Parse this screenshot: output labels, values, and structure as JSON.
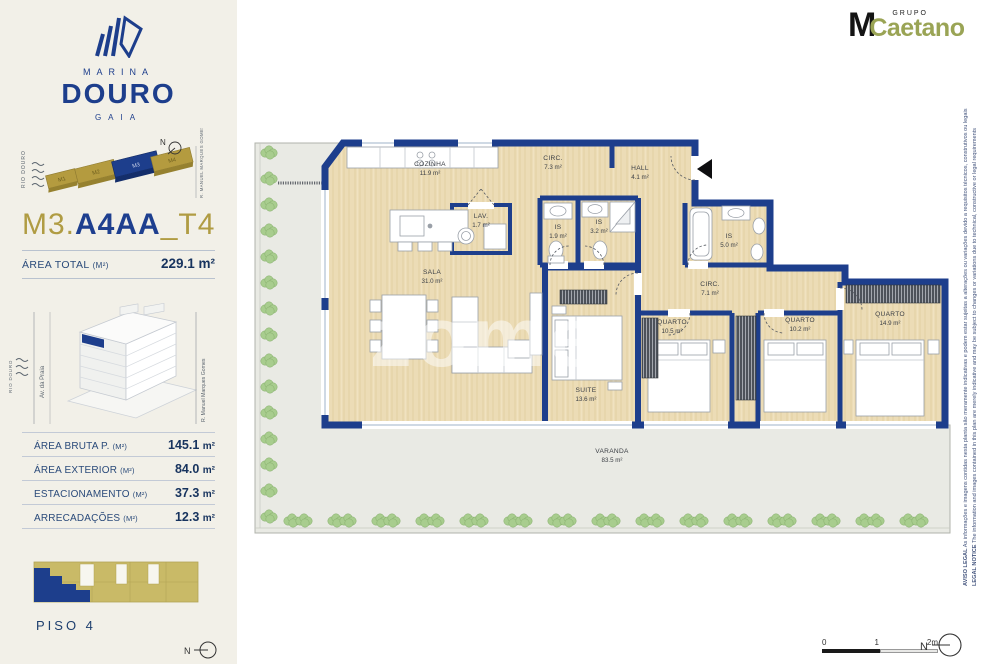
{
  "header": {
    "grupo": "GRUPO",
    "m": "M",
    "caetano": "Caetano"
  },
  "sidebar": {
    "brand": {
      "marina": "MARINA",
      "douro": "DOURO",
      "gaia": "GAIA"
    },
    "site_map": {
      "river": "RIO DOURO",
      "street": "R. MANUEL MARQUES GOMES",
      "north": "N",
      "blocks": [
        {
          "label": "M1",
          "highlight": false
        },
        {
          "label": "M2",
          "highlight": false
        },
        {
          "label": "M3",
          "highlight": true
        },
        {
          "label": "M4",
          "highlight": false
        }
      ]
    },
    "unit": {
      "prefix": "M3.",
      "code": "A4AA",
      "suffix": "_T4"
    },
    "area_total": {
      "label": "ÁREA TOTAL",
      "unit": "(M²)",
      "value": "229.1",
      "value_unit": "m²"
    },
    "building": {
      "river": "RIO DOURO",
      "street_left": "Av. da Praia",
      "street_right": "R. Manuel Marques Gomes"
    },
    "area_table": [
      {
        "label": "ÁREA BRUTA P.",
        "unit": "(M²)",
        "value": "145.1",
        "value_unit": "m²"
      },
      {
        "label": "ÁREA EXTERIOR",
        "unit": "(M²)",
        "value": "84.0",
        "value_unit": "m²"
      },
      {
        "label": "ESTACIONAMENTO",
        "unit": "(M²)",
        "value": "37.3",
        "value_unit": "m²"
      },
      {
        "label": "ARRECADAÇÕES",
        "unit": "(M²)",
        "value": "12.3",
        "value_unit": "m²"
      }
    ],
    "floor": {
      "label": "PISO 4",
      "north": "N"
    }
  },
  "plan": {
    "watermark": "zome",
    "rooms": [
      {
        "name": "COZINHA",
        "area": "11.9 m²",
        "x": 190,
        "y": 38
      },
      {
        "name": "CIRC.",
        "area": "7.3 m²",
        "x": 313,
        "y": 32
      },
      {
        "name": "HALL",
        "area": "4.1 m²",
        "x": 400,
        "y": 42
      },
      {
        "name": "LAV.",
        "area": "1.7 m²",
        "x": 241,
        "y": 90
      },
      {
        "name": "IS",
        "area": "1.9 m²",
        "x": 318,
        "y": 101
      },
      {
        "name": "IS",
        "area": "3.2 m²",
        "x": 359,
        "y": 96
      },
      {
        "name": "IS",
        "area": "5.0 m²",
        "x": 489,
        "y": 110
      },
      {
        "name": "SALA",
        "area": "31.0 m²",
        "x": 192,
        "y": 146
      },
      {
        "name": "SUITE",
        "area": "13.6 m²",
        "x": 346,
        "y": 264
      },
      {
        "name": "CIRC.",
        "area": "7.1 m²",
        "x": 470,
        "y": 158
      },
      {
        "name": "QUARTO",
        "area": "10.5 m²",
        "x": 432,
        "y": 196
      },
      {
        "name": "QUARTO",
        "area": "10.2 m²",
        "x": 560,
        "y": 194
      },
      {
        "name": "QUARTO",
        "area": "14.9 m²",
        "x": 650,
        "y": 188
      },
      {
        "name": "VARANDA",
        "area": "83.5 m²",
        "x": 372,
        "y": 325
      }
    ],
    "scale": {
      "t0": "0",
      "t1": "1",
      "t2": "2m"
    },
    "north": "N",
    "legal": {
      "pt_bold": "AVISO LEGAL",
      "pt": " As informações e imagens contidas nesta planta são meramente indicativas e podem estar sujeitas a alterações ou variações devido a requisitos técnicos, construtivos ou legais",
      "en_bold": "LEGAL NOTICE",
      "en": " The information and images contained in this plan are merely indicative and may be subject to changes or variations due to technical, constructive or legal requirements"
    }
  },
  "colors": {
    "navy": "#1d3e8c",
    "gold": "#b09c43",
    "olive": "#9aa455",
    "wood": "#ecdcb6",
    "terrace": "#e9eae4",
    "green": "#a8cd8e",
    "cream": "#f2f0e8"
  }
}
